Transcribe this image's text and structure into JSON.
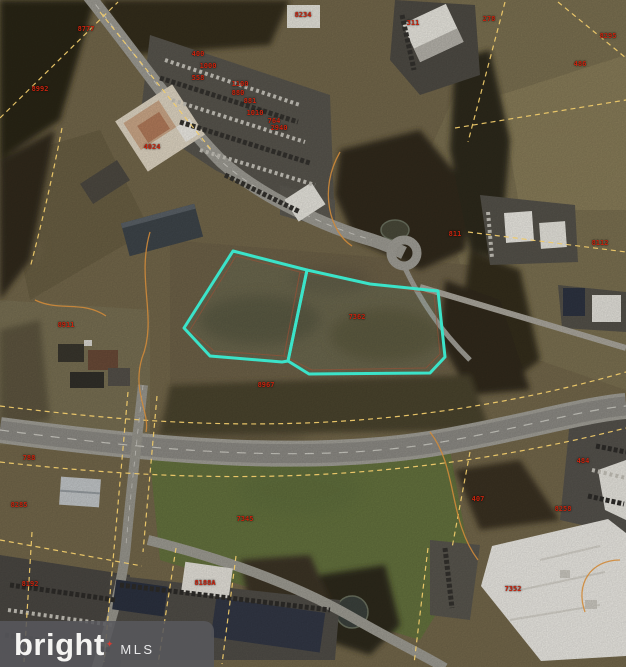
{
  "watermark": {
    "brand": "bright",
    "spark": "✦",
    "mls": "MLS"
  },
  "colors": {
    "parcel_highlight": "#3be3c9",
    "boundary_dashed": "#f0cb6b",
    "boundary_solid": "#cf8a3a",
    "label_red": "#c9250f"
  },
  "parcels": {
    "left_points": "233,251 307,270 288,361 282,362 210,356 184,328",
    "right_points": "307,270 370,284 438,291 445,357 430,373 309,374 288,361"
  },
  "labels": [
    {
      "x": 86,
      "y": 29,
      "text": "8777"
    },
    {
      "x": 40,
      "y": 89,
      "text": "8992"
    },
    {
      "x": 303,
      "y": 15,
      "text": "8234"
    },
    {
      "x": 489,
      "y": 19,
      "text": "278"
    },
    {
      "x": 413,
      "y": 23,
      "text": "311"
    },
    {
      "x": 608,
      "y": 36,
      "text": "8295"
    },
    {
      "x": 580,
      "y": 64,
      "text": "486"
    },
    {
      "x": 198,
      "y": 54,
      "text": "400"
    },
    {
      "x": 208,
      "y": 66,
      "text": "1000"
    },
    {
      "x": 198,
      "y": 78,
      "text": "558"
    },
    {
      "x": 240,
      "y": 84,
      "text": "1100"
    },
    {
      "x": 238,
      "y": 93,
      "text": "880"
    },
    {
      "x": 250,
      "y": 101,
      "text": "881"
    },
    {
      "x": 255,
      "y": 113,
      "text": "1010"
    },
    {
      "x": 274,
      "y": 121,
      "text": "764"
    },
    {
      "x": 279,
      "y": 128,
      "text": "2940"
    },
    {
      "x": 152,
      "y": 147,
      "text": "4024"
    },
    {
      "x": 455,
      "y": 234,
      "text": "811"
    },
    {
      "x": 600,
      "y": 243,
      "text": "8112"
    },
    {
      "x": 66,
      "y": 325,
      "text": "8911"
    },
    {
      "x": 357,
      "y": 317,
      "text": "7362"
    },
    {
      "x": 266,
      "y": 385,
      "text": "8967"
    },
    {
      "x": 29,
      "y": 458,
      "text": "788"
    },
    {
      "x": 19,
      "y": 505,
      "text": "8285"
    },
    {
      "x": 245,
      "y": 519,
      "text": "7345"
    },
    {
      "x": 583,
      "y": 461,
      "text": "484"
    },
    {
      "x": 478,
      "y": 499,
      "text": "407"
    },
    {
      "x": 563,
      "y": 509,
      "text": "8258"
    },
    {
      "x": 513,
      "y": 589,
      "text": "7352"
    },
    {
      "x": 30,
      "y": 584,
      "text": "8192"
    },
    {
      "x": 205,
      "y": 583,
      "text": "8188A"
    }
  ]
}
